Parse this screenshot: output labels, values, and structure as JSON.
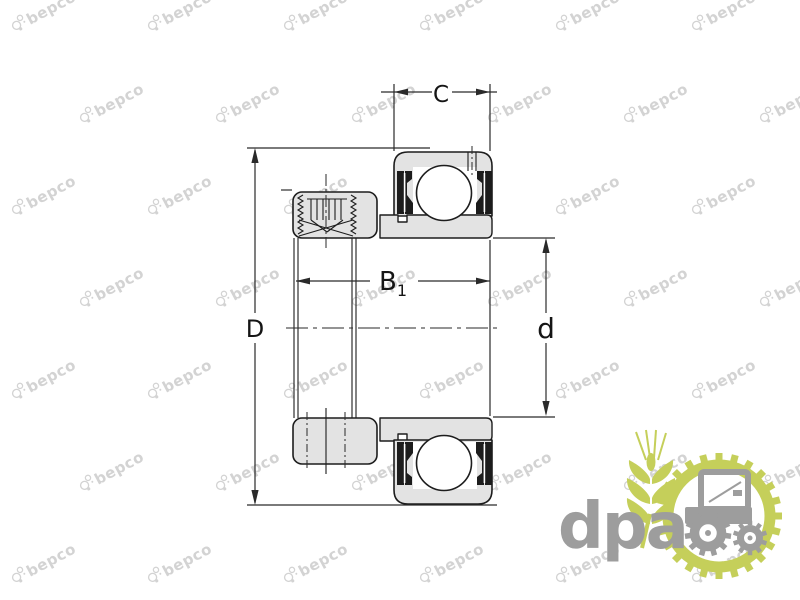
{
  "drawing": {
    "dim_outer_ring_width": {
      "label": "C"
    },
    "dim_outer_diameter": {
      "label": "D"
    },
    "dim_inner_ring_width": {
      "label": "B",
      "subscript": "1"
    },
    "dim_bore_diameter": {
      "label": "d"
    }
  },
  "watermark": {
    "text": "bepco",
    "color": "#d3d3d3"
  },
  "brand_logo": {
    "text": "dpa",
    "text_color": "#9d9d9d",
    "accent_color": "#c5cf5a"
  },
  "colors": {
    "line": "#1d1d1d",
    "part_fill": "#e3e3e3",
    "dim_line": "#2a2a2a",
    "background": "#ffffff"
  }
}
